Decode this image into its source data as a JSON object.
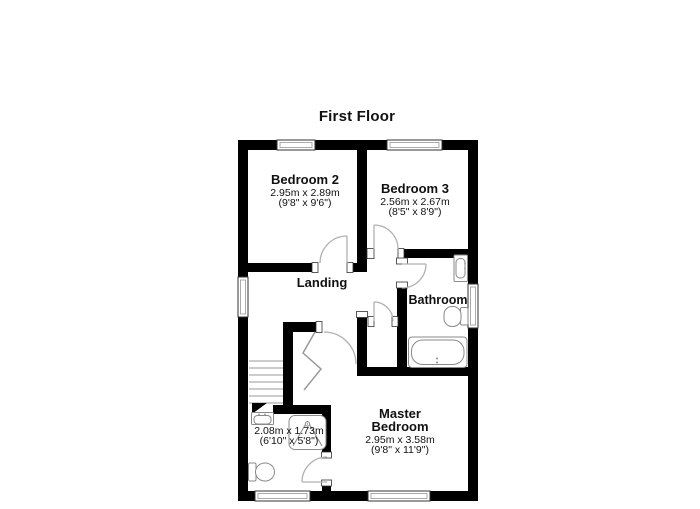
{
  "title": "First Floor",
  "rooms": {
    "bedroom2": {
      "name": "Bedroom 2",
      "dim_metric": "2.95m x 2.89m",
      "dim_imperial": "(9'8\" x 9'6\")"
    },
    "bedroom3": {
      "name": "Bedroom 3",
      "dim_metric": "2.56m x 2.67m",
      "dim_imperial": "(8'5\" x 8'9\")"
    },
    "landing": {
      "name": "Landing"
    },
    "bathroom": {
      "name": "Bathroom"
    },
    "ensuite": {
      "dim_metric": "2.08m x 1.73m",
      "dim_imperial": "(6'10\" x 5'8\")"
    },
    "master_bedroom": {
      "name_line1": "Master",
      "name_line2": "Bedroom",
      "dim_metric": "2.95m x 3.58m",
      "dim_imperial": "(9'8\" x 11'9\")"
    }
  },
  "colors": {
    "wall": "#000000",
    "background": "#ffffff",
    "fixture_outline": "#8a8a8a",
    "door_arc": "#b0b0b0",
    "stair_line": "#999999",
    "text": "#111111"
  }
}
